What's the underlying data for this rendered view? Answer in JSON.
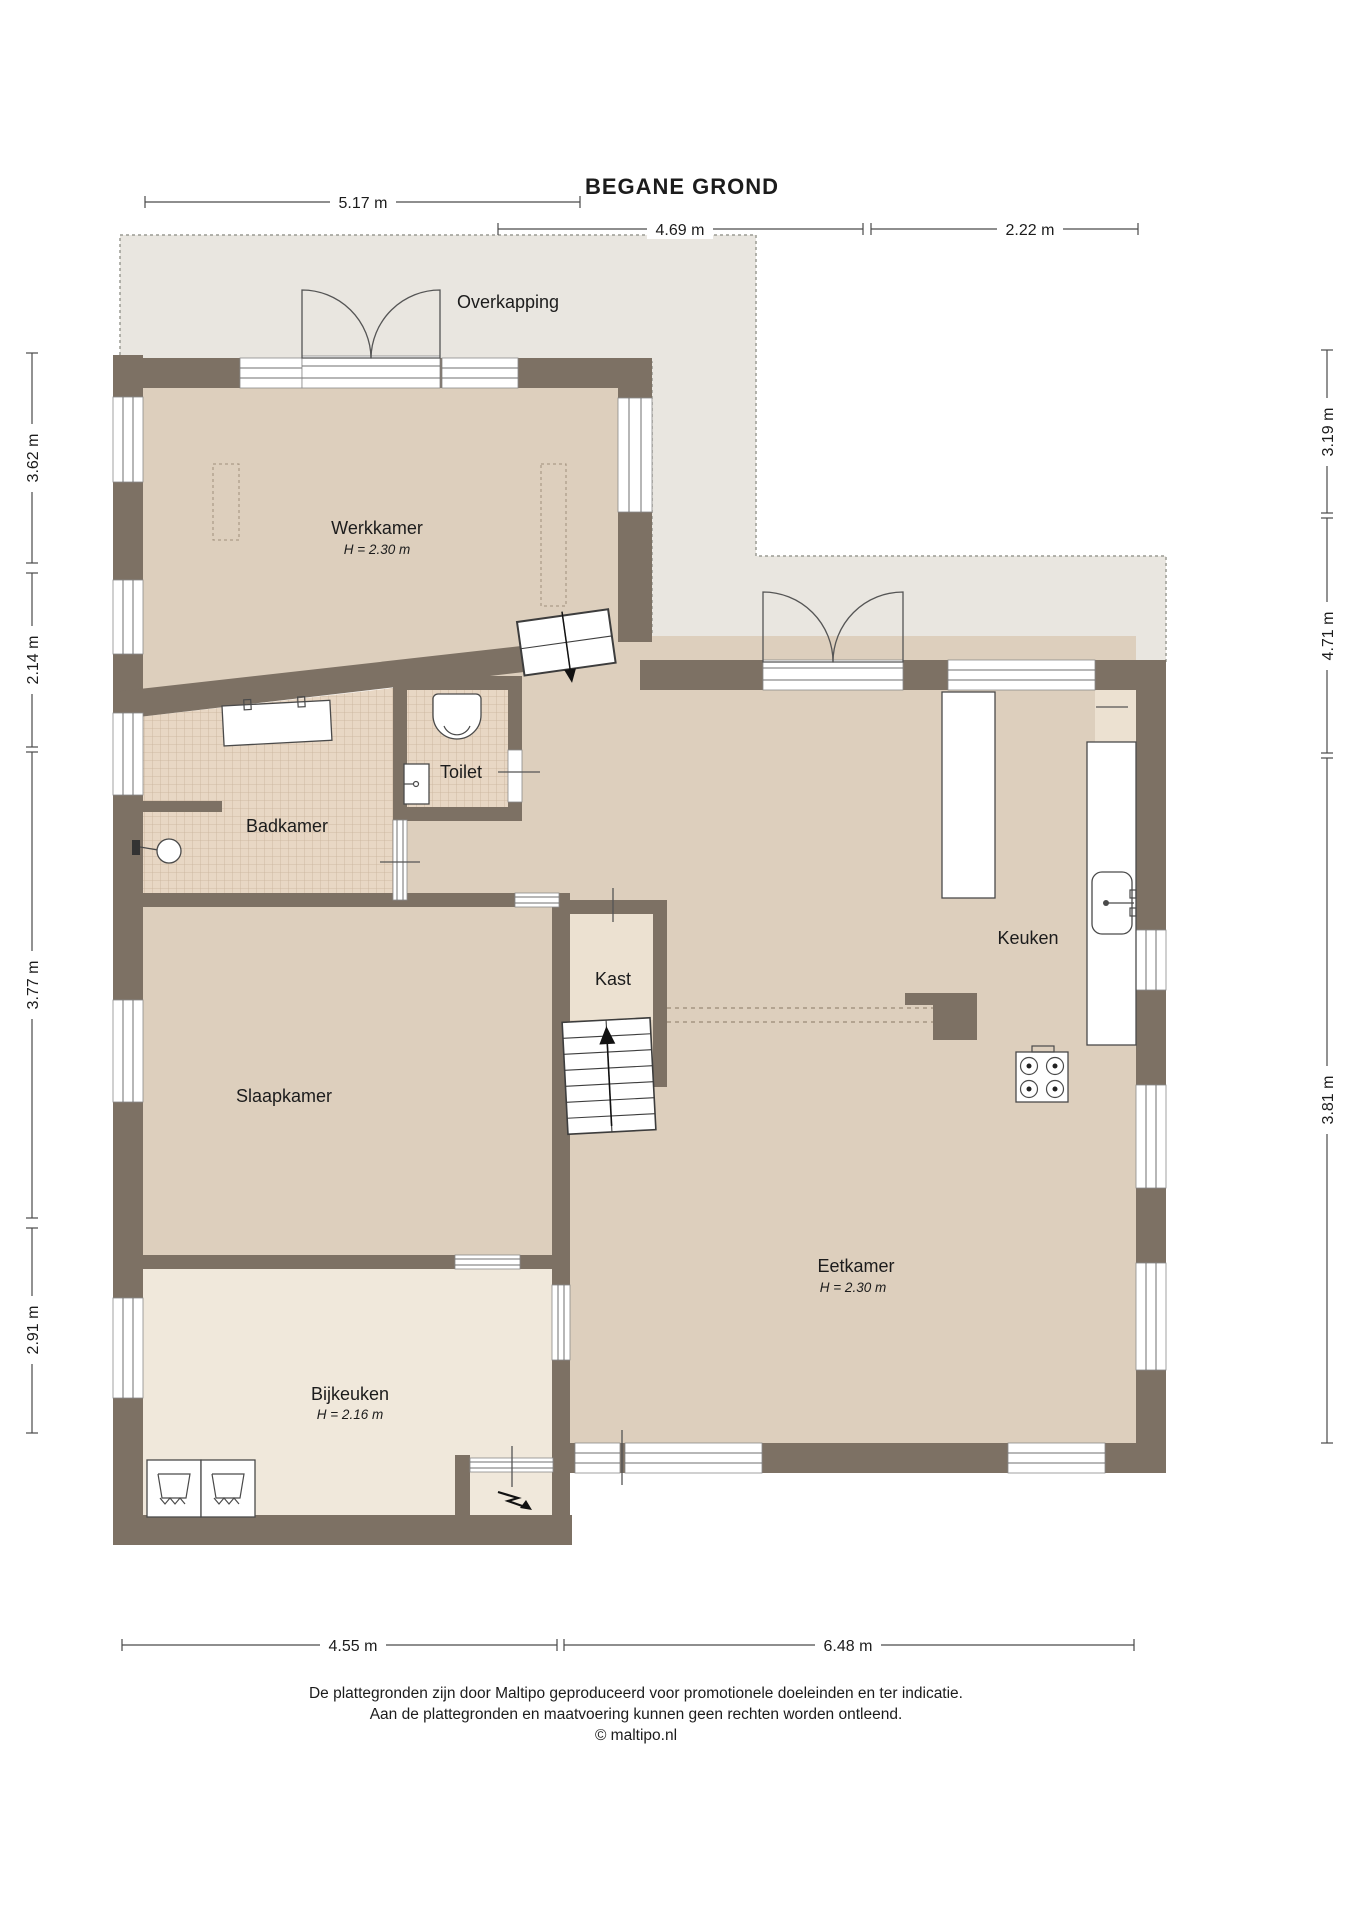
{
  "title": "BEGANE GROND",
  "overkapping_label": "Overkapping",
  "rooms": [
    {
      "id": "werkkamer",
      "name": "Werkkamer",
      "height": "H = 2.30 m"
    },
    {
      "id": "badkamer",
      "name": "Badkamer",
      "height": ""
    },
    {
      "id": "toilet",
      "name": "Toilet",
      "height": ""
    },
    {
      "id": "kast",
      "name": "Kast",
      "height": ""
    },
    {
      "id": "slaapkamer",
      "name": "Slaapkamer",
      "height": ""
    },
    {
      "id": "keuken",
      "name": "Keuken",
      "height": ""
    },
    {
      "id": "eetkamer",
      "name": "Eetkamer",
      "height": "H = 2.30 m"
    },
    {
      "id": "bijkeuken",
      "name": "Bijkeuken",
      "height": "H = 2.16 m"
    }
  ],
  "dimensions": {
    "top": [
      {
        "label": "5.17 m"
      },
      {
        "label": "4.69 m"
      },
      {
        "label": "2.22 m"
      }
    ],
    "left": [
      {
        "label": "3.62 m"
      },
      {
        "label": "2.14 m"
      },
      {
        "label": "3.77 m"
      },
      {
        "label": "2.91 m"
      }
    ],
    "right": [
      {
        "label": "3.19 m"
      },
      {
        "label": "4.71 m"
      },
      {
        "label": "3.81 m"
      }
    ],
    "bottom": [
      {
        "label": "4.55 m"
      },
      {
        "label": "6.48 m"
      }
    ]
  },
  "footer": {
    "line1": "De plattegronden zijn door Maltipo geproduceerd voor promotionele doeleinden en ter indicatie.",
    "line2": "Aan de plattegronden en maatvoering kunnen geen rechten worden ontleend.",
    "line3": "© maltipo.nl"
  },
  "colors": {
    "wall": "#7d7164",
    "floor_tan": "#ddcfbd",
    "floor_light": "#f0e8db",
    "floor_closet": "#ece1d1",
    "tile": "#e8d7c4",
    "tile_grid": "#c8b29a",
    "overkapping": "#e9e6e0",
    "background": "#ffffff"
  }
}
